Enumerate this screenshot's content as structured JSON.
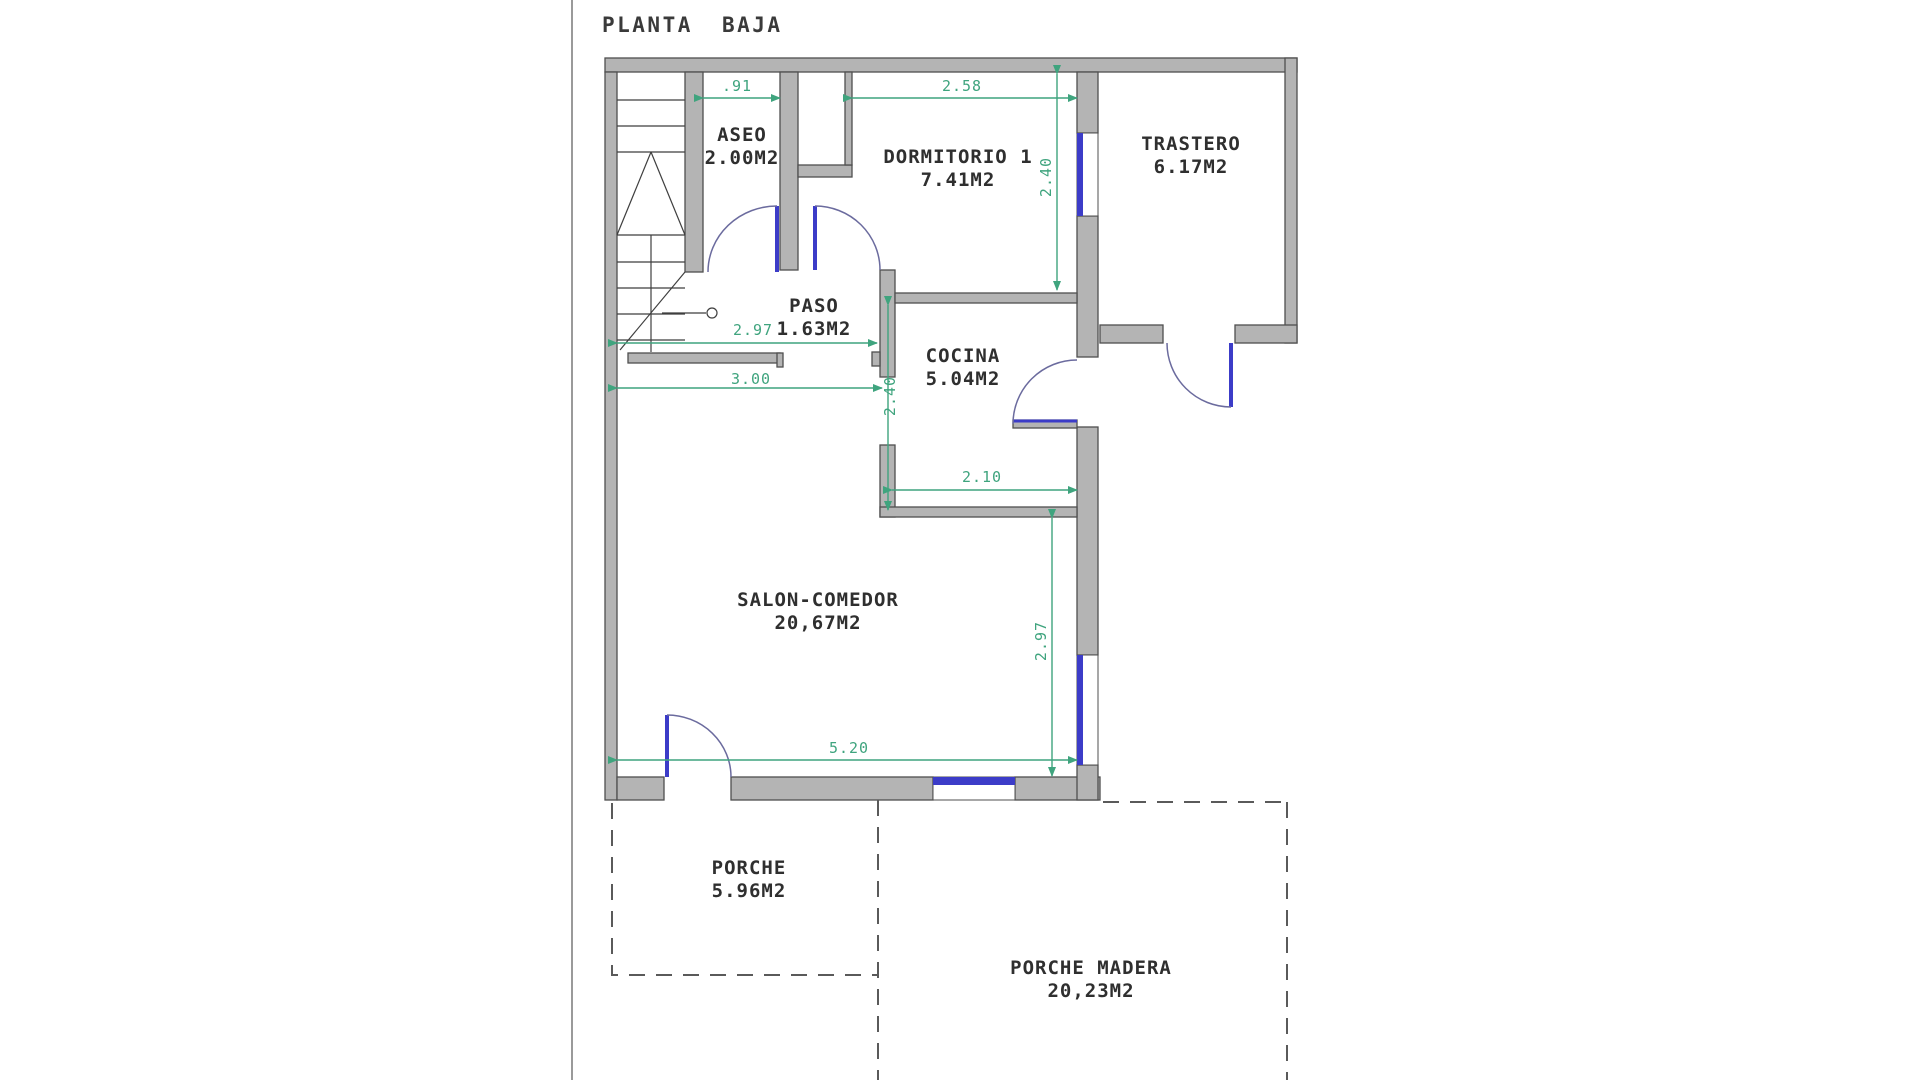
{
  "title": "PLANTA BAJA",
  "colors": {
    "wall_fill": "#b4b4b4",
    "wall_stroke": "#4f4f4f",
    "dimension_green": "#3FA47E",
    "door_window_blue": "#3C3CC8",
    "door_arc": "#6b6b9e",
    "text": "#2f2f2f",
    "dashed_outline": "#5a5a5a",
    "page_border": "#999999"
  },
  "rooms": {
    "aseo": {
      "name": "ASEO",
      "area": "2.00M2"
    },
    "dormitorio": {
      "name": "DORMITORIO 1",
      "area": "7.41M2"
    },
    "trastero": {
      "name": "TRASTERO",
      "area": "6.17M2"
    },
    "paso": {
      "name": "PASO",
      "area": "1.63M2"
    },
    "cocina": {
      "name": "COCINA",
      "area": "5.04M2"
    },
    "salon": {
      "name": "SALON-COMEDOR",
      "area": "20,67M2"
    },
    "porche": {
      "name": "PORCHE",
      "area": "5.96M2"
    },
    "porche_madera": {
      "name": "PORCHE MADERA",
      "area": "20,23M2"
    }
  },
  "dimensions": {
    "aseo_width": ".91",
    "dormitorio_width": "2.58",
    "dormitorio_height": "2.40",
    "paso_width": "2.97",
    "salon_width_top": "3.00",
    "cocina_height": "2.40",
    "cocina_width": "2.10",
    "salon_height": "2.97",
    "salon_width_bottom": "5.20"
  }
}
